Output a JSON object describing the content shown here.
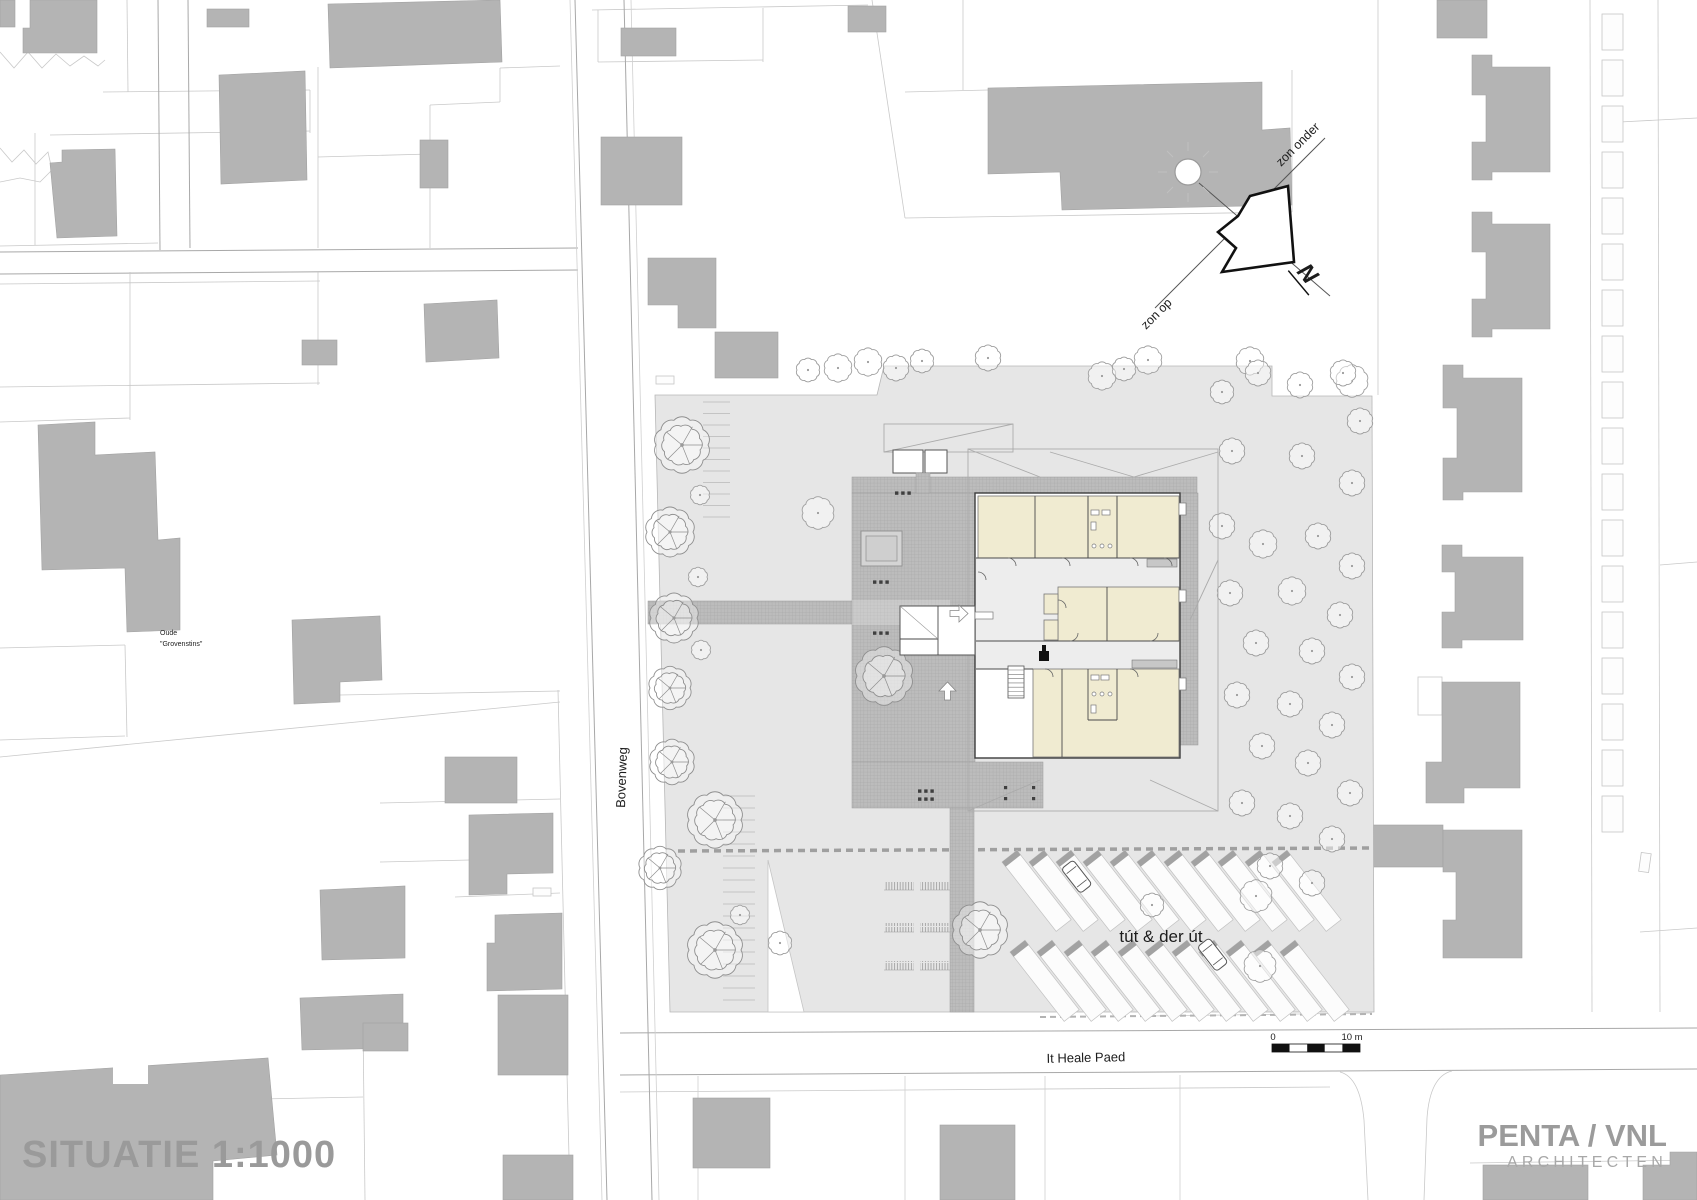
{
  "meta": {
    "drawing_type": "architectural site plan",
    "sheet_width_px": 1697,
    "sheet_height_px": 1200
  },
  "title": {
    "text": "SITUATIE 1:1000"
  },
  "logo": {
    "line1": "PENTA / VNL",
    "line2": "ARCHITECTEN"
  },
  "streets": {
    "bovenweg": "Bovenweg",
    "it_heale_paed": "It Heale Paed"
  },
  "labels": {
    "site_name": "tút & der út",
    "old_building_line1": "Oude",
    "old_building_line2": "\"Grovenstins\""
  },
  "compass": {
    "sunrise": "zon op",
    "sunset": "zon onder",
    "north": "N"
  },
  "scale_bar": {
    "start": "0",
    "end": "10 m"
  },
  "colors": {
    "background": "#ffffff",
    "building_footprint": "#b4b4b4",
    "site_area": "#e6e6e6",
    "paving": "#bcbcbc",
    "paving_grid": "#a4a4a4",
    "room_cream": "#f0ebd1",
    "wall_dark": "#3c3c3c",
    "parcel_line": "#c9c9c9",
    "road_line": "#a8a8a8",
    "text_dark": "#1c1c1c",
    "muted_gray": "#9a9a9a"
  }
}
